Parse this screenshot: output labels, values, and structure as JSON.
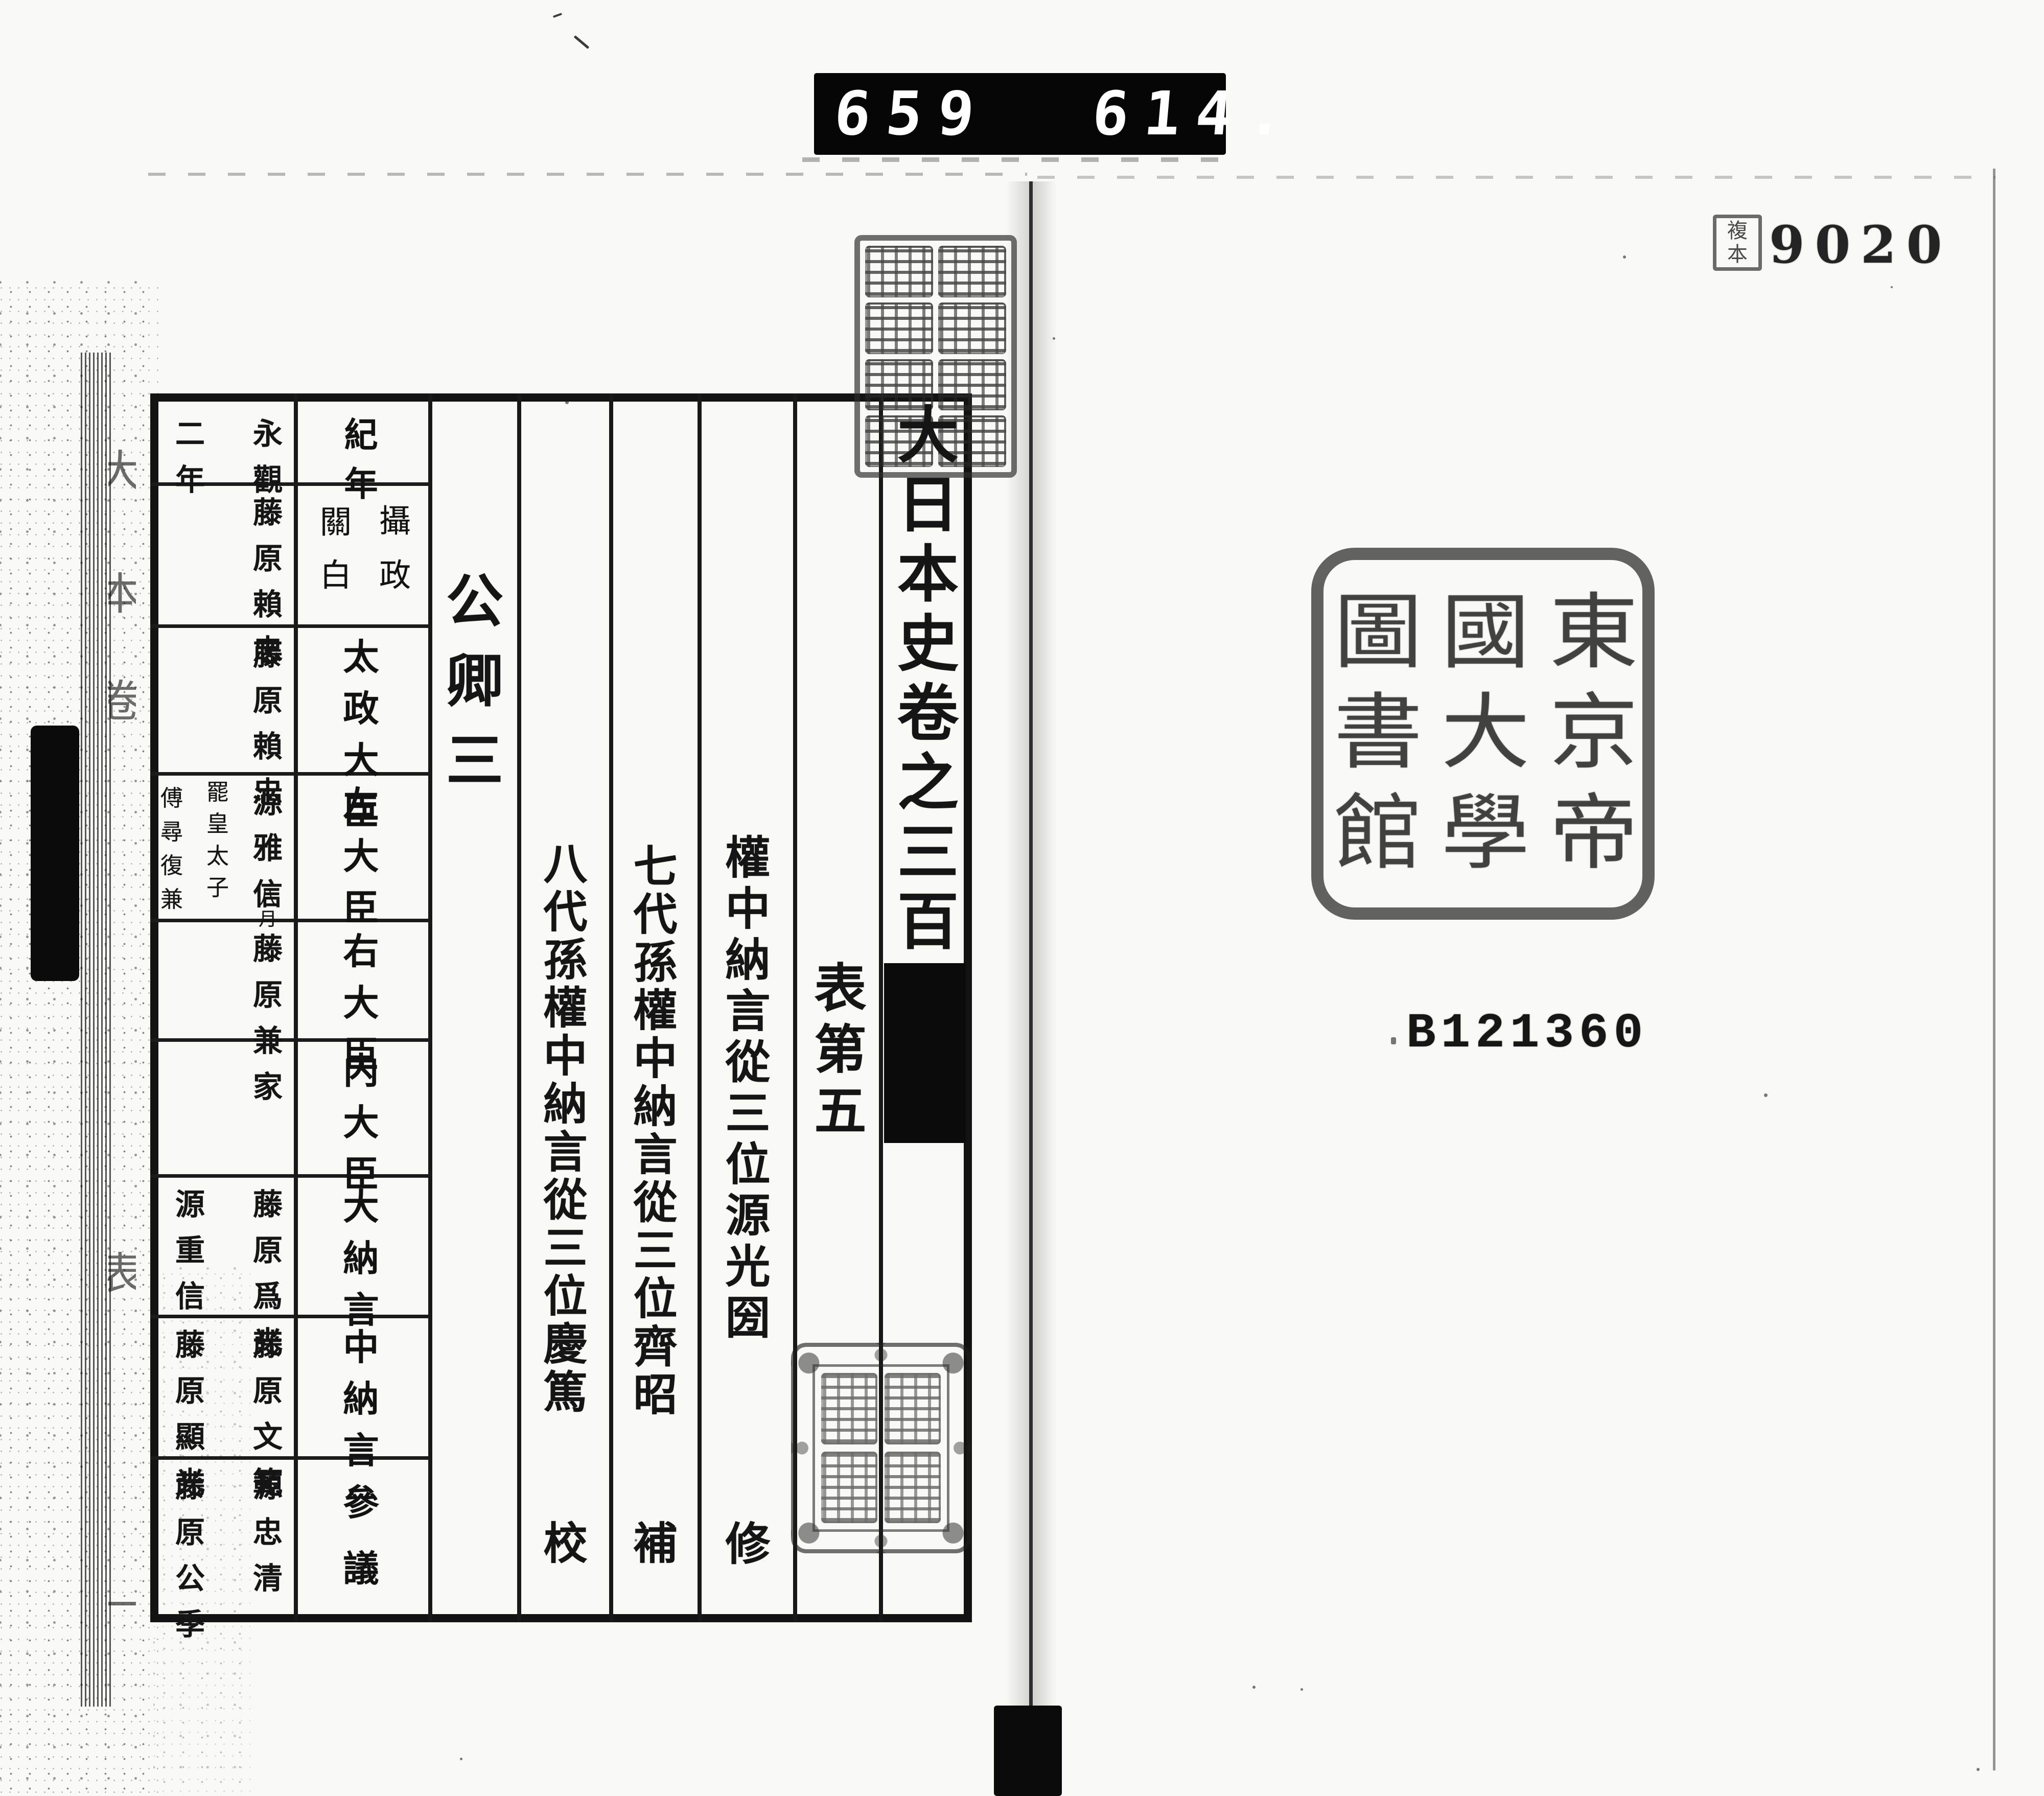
{
  "film_counter": {
    "left": "659",
    "right": "614."
  },
  "right_page": {
    "copy_stamp_text": "複本",
    "copy_number": "9020",
    "accession_number": "B121360",
    "library_seal": {
      "columns": [
        [
          "東",
          "京",
          "帝"
        ],
        [
          "國",
          "大",
          "學"
        ],
        [
          "圖",
          "書",
          "館"
        ]
      ]
    }
  },
  "left_page": {
    "volume_title": "大日本史卷之三百",
    "section_title": "表第五",
    "chapter_heading": "公卿三",
    "editors": [
      {
        "name": "權中納言從三位源光圀",
        "role": "修"
      },
      {
        "name": "七代孫權中納言從三位齊昭",
        "role": "補"
      },
      {
        "name": "八代孫權中納言從三位慶篤",
        "role": "校"
      }
    ],
    "table": {
      "rows": [
        {
          "header": "紀年",
          "entries": [
            "永觀",
            "二年"
          ]
        },
        {
          "header": "攝政關白",
          "header_columns": [
            "攝政",
            "關白"
          ],
          "entries": [
            "藤原賴忠"
          ]
        },
        {
          "header": "太政大臣",
          "entries": [
            "藤原賴忠"
          ]
        },
        {
          "header": "左大臣",
          "entries": [
            "源雅信"
          ],
          "notes": [
            "八月",
            "罷皇太子",
            "傅尋復兼"
          ]
        },
        {
          "header": "右大臣",
          "entries": [
            "藤原兼家"
          ]
        },
        {
          "header": "内大臣",
          "entries": []
        },
        {
          "header": "大納言",
          "entries": [
            "藤原爲光",
            "源重信"
          ]
        },
        {
          "header": "中納言",
          "entries": [
            "藤原文範",
            "藤原顯光"
          ]
        },
        {
          "header": "參議",
          "entries": [
            "源忠清",
            "藤原公季"
          ]
        }
      ]
    },
    "spine_edge_chars": [
      "大",
      "本",
      "卷",
      "表",
      "一"
    ]
  }
}
